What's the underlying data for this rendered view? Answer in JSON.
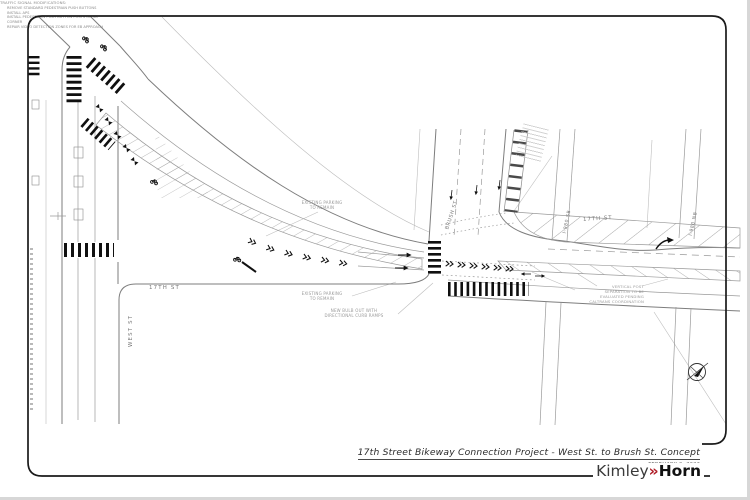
{
  "title_block": {
    "title": "17th Street Bikeway Connection Project - West St. to Brush St. Concept",
    "date": "FEBRUARY 2, 2022",
    "logo_kimley": "Kimley",
    "logo_chevrons": "»",
    "logo_horn": "Horn"
  },
  "streets": {
    "seventeenth_west": "17TH ST",
    "seventeenth_east": "17TH ST",
    "west_street": "WEST ST",
    "brush_street": "BRUSH ST",
    "i980_sb_ramp": "I-980 SB",
    "i980_nb_ramp": "I-980 NB"
  },
  "annotations": {
    "existing_parking_upper": "EXISTING PARKING\nTO REMAIN",
    "existing_parking_lower": "EXISTING PARKING\nTO REMAIN",
    "new_bulb_out": "NEW BULB OUT WITH\nDIRECTIONAL CURB RAMPS",
    "vertical_post": "VERTICAL POST\nSEPARATION TO BE\nEVALUATED PENDING\nCALTRANS COORDINATION",
    "signal_heading": "TRAFFIC SIGNAL MODIFICATIONS:",
    "signal_items": [
      "REMOVE STANDARD PEDESTRIAN PUSH BUTTONS",
      "INSTALL APS",
      "INSTALL PEDESTRIAN PUSH BUTTON POSTS ON SB CORNER",
      "REPAIR VIDEO DETECTION ZONES FOR EB APPROACH"
    ]
  },
  "colors": {
    "logo_red": "#b01e28",
    "line_gray": "#9a9a9a",
    "ink": "#1a1a1a"
  }
}
